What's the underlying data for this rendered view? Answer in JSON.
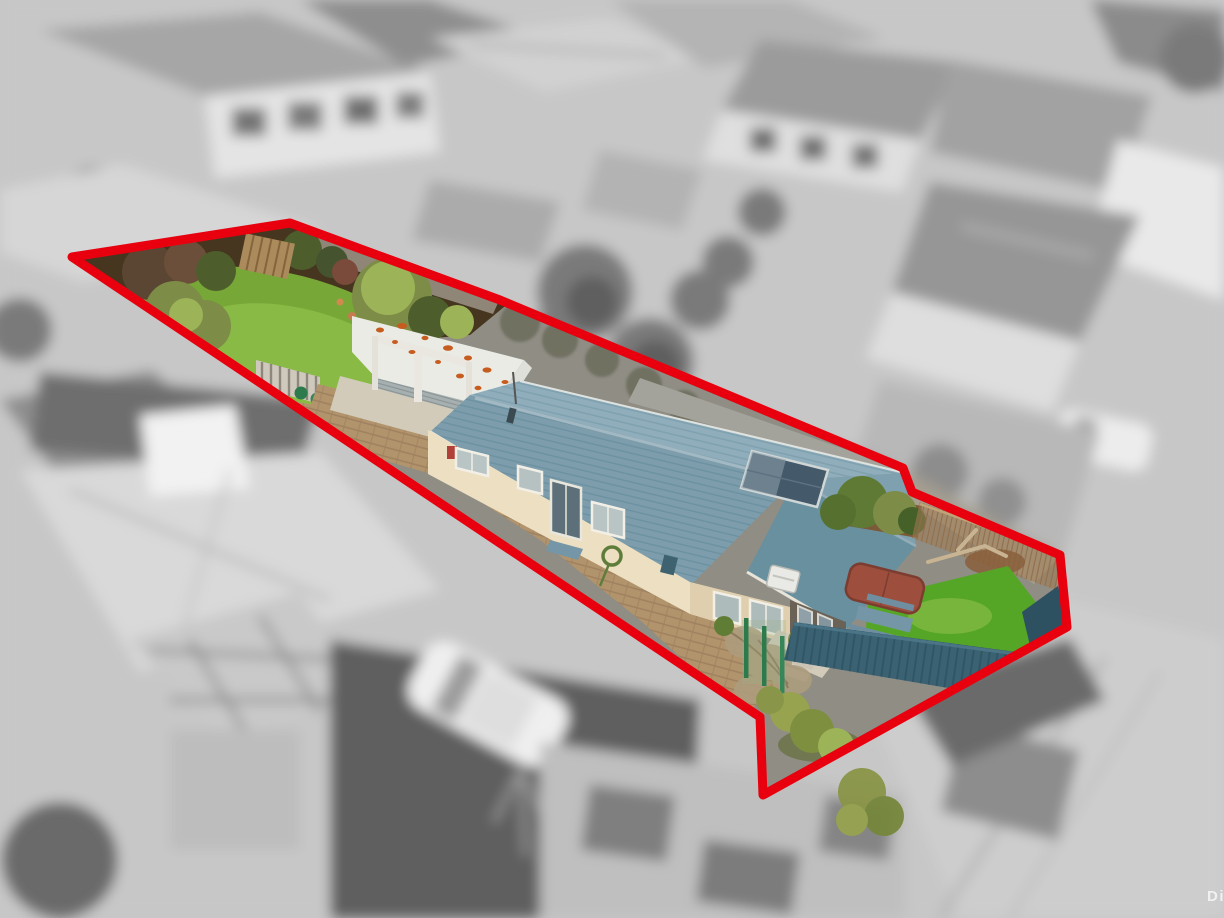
{
  "image": {
    "kind": "aerial-real-estate-photo",
    "watermark_partial": "Di",
    "effects": [
      "surroundings blurred and desaturated to grayscale",
      "property lot shown sharp and in full color",
      "red boundary outline drawn around lot"
    ]
  },
  "boundary": {
    "points": "72,257 290,223 500,300 903,468 912,492 1060,555 1067,627 763,795 760,717",
    "stroke_width": "9",
    "color": "#e8000f"
  },
  "colors": {
    "boundary_red": "#e8000f",
    "roof_blue": "#7d9dac",
    "roof_blue_dark": "#69909f",
    "roof_blue_light": "#8fadbb",
    "garage_roof": "#e9ebe4",
    "rust_orange": "#c75c1f",
    "wall_cream": "#ecdfc2",
    "wall_cream_shade": "#dfcfae",
    "paver_tan": "#b2946c",
    "paver_line": "#96785a",
    "concrete": "#d2cbba",
    "lawn_back": "#77a737",
    "lawn_front": "#55a626",
    "lawn_light": "#8fc04b",
    "soil_brown": "#46351f",
    "shrub_olive": "#7d8c46",
    "shrub_dark": "#4d5e2c",
    "shrub_light": "#9cb358",
    "fence_teal": "#3a6272",
    "fence_teal_dark": "#2e5161",
    "bamboo_tan": "#a17c53",
    "bamboo_dark": "#7b5a39",
    "spa_red": "#9d4e3d",
    "table_blue": "#7596a6",
    "gate_green": "#2d7b4c",
    "wood_tan": "#ab8a5c",
    "watermark_white": "#ffffff"
  },
  "scene": {
    "background": {
      "style": "blurred grayscale suburban aerial view",
      "elements": [
        "neighbouring house roofs",
        "trees and hedges",
        "conservatory",
        "white parked cars",
        "driveways",
        "road and footpath"
      ]
    },
    "property": {
      "features": [
        "rear lawn and garden beds",
        "shrubs",
        "timber fence panel",
        "picket gate with planter pots",
        "double garage with white iron roof and rust patches",
        "brick paved driveway",
        "weatherboard house with blue tiled hip roof",
        "solar panel on roof",
        "windows and glazed door",
        "heat pump",
        "concrete porch and steps",
        "spa pool with red-brown cover",
        "blue picnic table",
        "front lawn",
        "teal slat fence",
        "bamboo screen fence",
        "green chain-link gate",
        "climbing vine",
        "bushes at street frontage"
      ]
    }
  }
}
